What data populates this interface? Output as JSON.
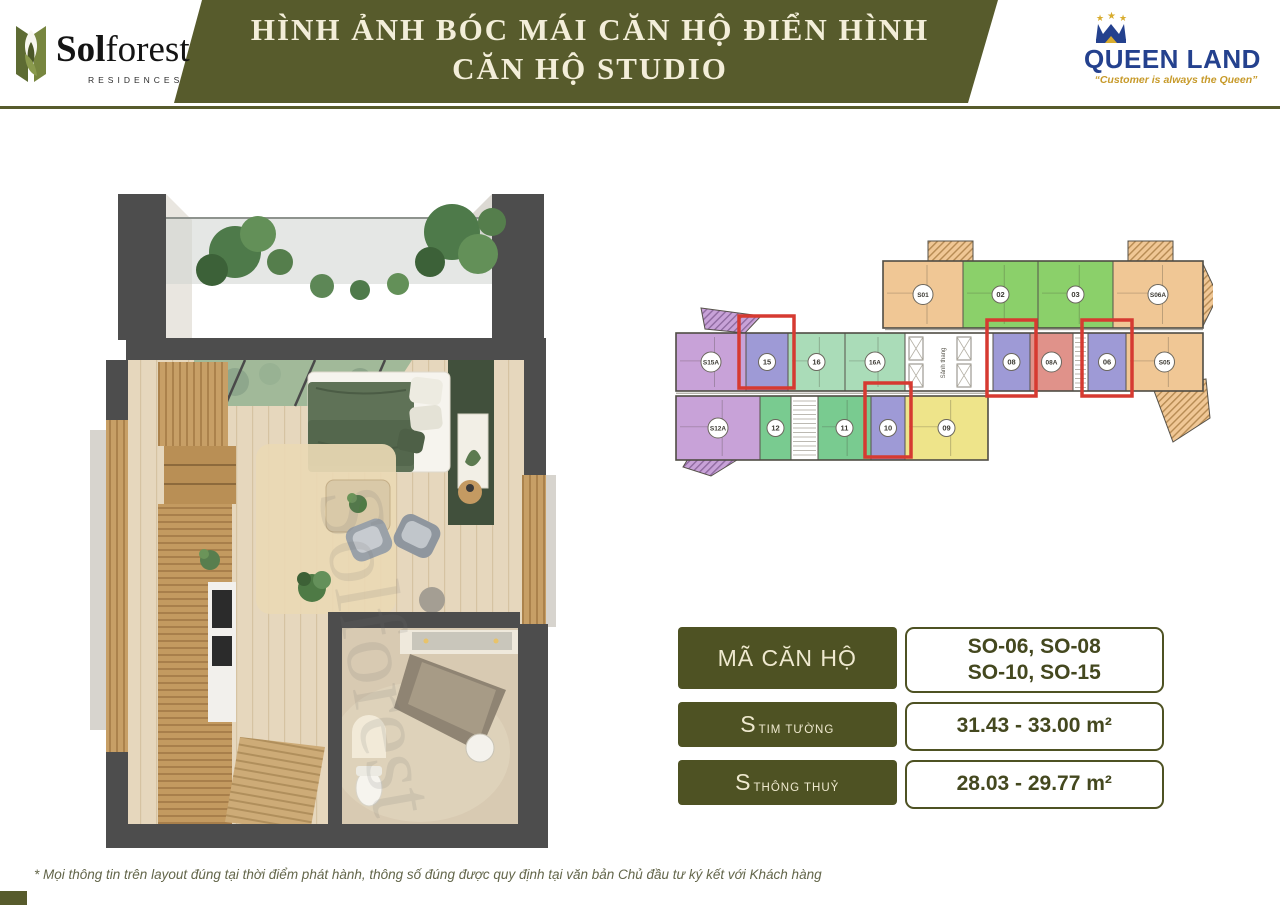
{
  "header": {
    "brand": {
      "name_bold": "Sol",
      "name_rest": "forest",
      "sub": "RESIDENCES"
    },
    "title1": "HÌNH ẢNH BÓC MÁI CĂN HỘ ĐIỂN HÌNH",
    "title2": "CĂN HỘ STUDIO",
    "partner": {
      "name": "QUEEN LAND",
      "tagline": "“Customer is always the Queen”"
    }
  },
  "colors": {
    "olive": "#575b2c",
    "olive_dark": "#4e5223",
    "cream": "#f3eed9",
    "value_text": "#44481f",
    "navy": "#24418e",
    "gold": "#c79a2a",
    "highlight_red": "#d63a31"
  },
  "info": {
    "rows": [
      {
        "label": "MÃ CĂN HỘ",
        "values": [
          "SO-06, SO-08",
          "SO-10, SO-15"
        ]
      },
      {
        "label_main": "S",
        "label_sub": "TIM TƯỜNG",
        "value": "31.43 - 33.00 m²"
      },
      {
        "label_main": "S",
        "label_sub": "THÔNG THUỶ",
        "value": "28.03 - 29.77 m²"
      }
    ]
  },
  "watermark": "Solforest",
  "footer": {
    "disclaimer": "* Mọi thông tin trên layout đúng tại thời điểm phát hành, thông số đúng được quy định tại văn bản Chủ đầu tư ký kết với Khách hàng"
  },
  "floorplan": {
    "core_label": "Sảnh thang",
    "palette": {
      "orange": "#f0c795",
      "green": "#8bd06a",
      "mint": "#aadcb8",
      "dgreen": "#79cb90",
      "purple": "#c8a2d8",
      "peri": "#9e9ad6",
      "salmon": "#e0928a",
      "yellow": "#eee48a",
      "white": "#ffffff"
    },
    "bands": [
      {
        "x": 210,
        "y": 25,
        "w": 320,
        "h": 67
      },
      {
        "x": 3,
        "y": 97,
        "w": 527,
        "h": 58
      },
      {
        "x": 3,
        "y": 160,
        "w": 312,
        "h": 64
      }
    ],
    "units": [
      {
        "label": "S01",
        "x": 210,
        "y": 25,
        "w": 80,
        "h": 67,
        "color": "orange",
        "r": 10
      },
      {
        "label": "02",
        "x": 290,
        "y": 25,
        "w": 75,
        "h": 67,
        "color": "green",
        "r": 8.5
      },
      {
        "label": "03",
        "x": 365,
        "y": 25,
        "w": 75,
        "h": 67,
        "color": "green",
        "r": 8.5
      },
      {
        "label": "S06A",
        "x": 440,
        "y": 25,
        "w": 90,
        "h": 67,
        "color": "orange",
        "r": 10
      },
      {
        "label": "S15A",
        "x": 3,
        "y": 97,
        "w": 70,
        "h": 58,
        "color": "purple",
        "r": 10
      },
      {
        "label": "15",
        "x": 73,
        "y": 97,
        "w": 42,
        "h": 58,
        "color": "peri",
        "r": 8.5,
        "hl": [
          66,
          80,
          55,
          72
        ]
      },
      {
        "label": "16",
        "x": 115,
        "y": 97,
        "w": 57,
        "h": 58,
        "color": "mint",
        "r": 8.5
      },
      {
        "label": "16A",
        "x": 172,
        "y": 97,
        "w": 60,
        "h": 58,
        "color": "mint",
        "r": 10
      },
      {
        "label": "08",
        "x": 320,
        "y": 97,
        "w": 37,
        "h": 58,
        "color": "peri",
        "r": 8.5,
        "hl": [
          314,
          84,
          49,
          76
        ]
      },
      {
        "label": "08A",
        "x": 357,
        "y": 97,
        "w": 43,
        "h": 58,
        "color": "salmon",
        "r": 10
      },
      {
        "label": "06",
        "x": 415,
        "y": 97,
        "w": 38,
        "h": 58,
        "color": "peri",
        "r": 8.5,
        "hl": [
          409,
          84,
          50,
          76
        ]
      },
      {
        "label": "S05",
        "x": 453,
        "y": 97,
        "w": 77,
        "h": 58,
        "color": "orange",
        "r": 10
      },
      {
        "label": "S12A",
        "x": 3,
        "y": 160,
        "w": 84,
        "h": 64,
        "color": "purple",
        "r": 10
      },
      {
        "label": "12",
        "x": 87,
        "y": 160,
        "w": 31,
        "h": 64,
        "color": "dgreen",
        "r": 8.5
      },
      {
        "label": "11",
        "x": 145,
        "y": 160,
        "w": 53,
        "h": 64,
        "color": "dgreen",
        "r": 8.5
      },
      {
        "label": "10",
        "x": 198,
        "y": 160,
        "w": 34,
        "h": 64,
        "color": "peri",
        "r": 8.5,
        "hl": [
          192,
          147,
          46,
          74
        ]
      },
      {
        "label": "09",
        "x": 232,
        "y": 160,
        "w": 83,
        "h": 64,
        "color": "yellow",
        "r": 8.5
      }
    ],
    "core": {
      "x": 232,
      "y": 97,
      "w": 88,
      "h": 58
    },
    "stairs": [
      {
        "x": 400,
        "y": 97,
        "w": 15,
        "h": 58
      },
      {
        "x": 118,
        "y": 160,
        "w": 27,
        "h": 64
      }
    ],
    "decor": [
      {
        "points": "255,5 300,5 300,25 255,25",
        "hatch": "orange"
      },
      {
        "points": "455,5 500,5 500,25 455,25",
        "hatch": "orange"
      },
      {
        "points": "530,28 545,60 530,90",
        "hatch": "orange"
      },
      {
        "points": "480,152 533,143 537,182 500,206",
        "hatch": "orange"
      },
      {
        "points": "28,72 88,80 72,97 32,93",
        "hatch": "purple"
      },
      {
        "points": "18,218 64,224 38,240 10,231",
        "hatch": "purple"
      }
    ]
  }
}
